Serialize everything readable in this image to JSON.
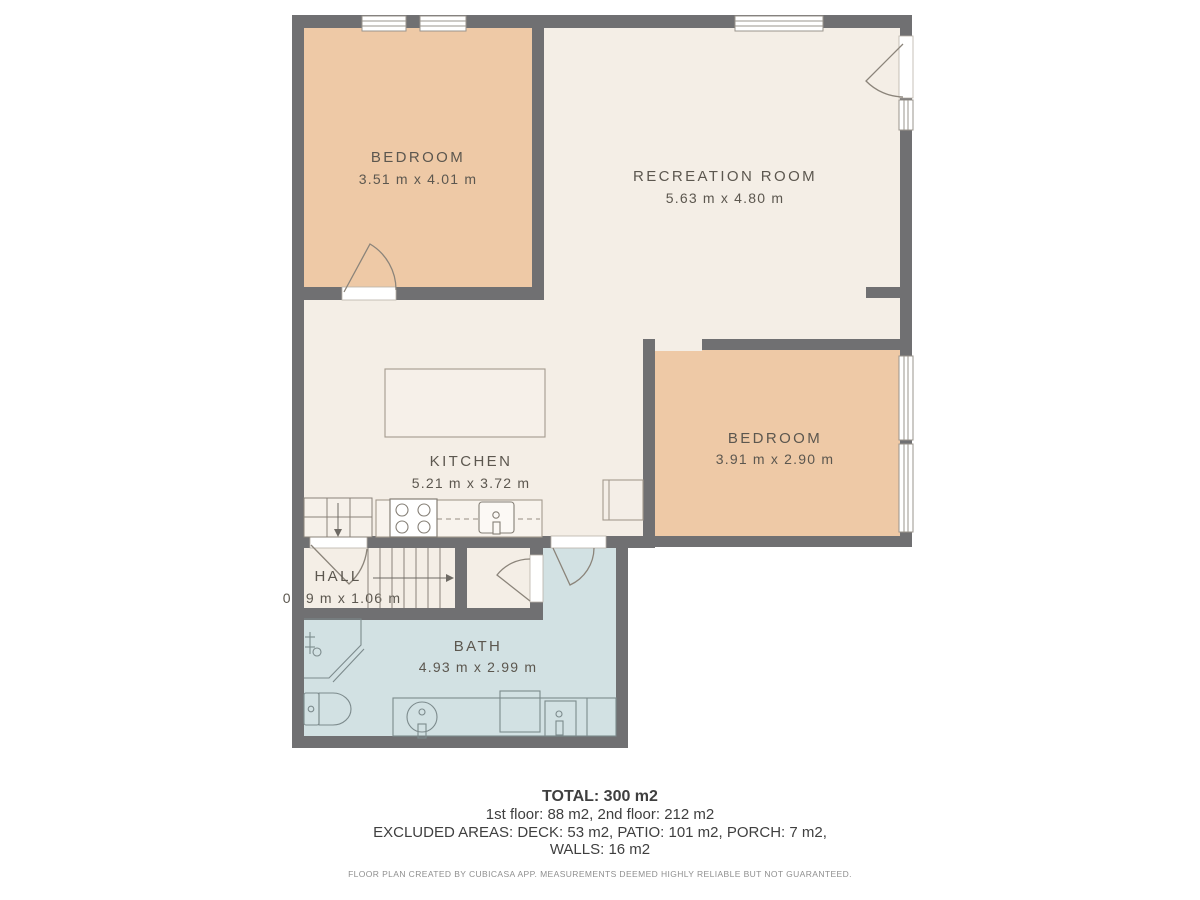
{
  "rooms": [
    {
      "id": "bedroom-1",
      "name": "BEDROOM",
      "dims": "3.51 m x 4.01 m"
    },
    {
      "id": "recreation-room",
      "name": "RECREATION ROOM",
      "dims": "5.63 m x 4.80 m"
    },
    {
      "id": "bedroom-2",
      "name": "BEDROOM",
      "dims": "3.91 m x 2.90 m"
    },
    {
      "id": "kitchen",
      "name": "KITCHEN",
      "dims": "5.21 m x 3.72 m"
    },
    {
      "id": "hall",
      "name": "HALL",
      "dims": "0.99 m x 1.06 m"
    },
    {
      "id": "bath",
      "name": "BATH",
      "dims": "4.93 m x 2.99 m"
    }
  ],
  "summary": {
    "total": "TOTAL: 300 m2",
    "floors": "1st floor: 88 m2, 2nd floor: 212 m2",
    "excluded_line1": "EXCLUDED AREAS: DECK: 53 m2, PATIO: 101 m2, PORCH: 7 m2,",
    "excluded_line2": "WALLS: 16 m2",
    "disclaimer": "FLOOR PLAN CREATED BY CUBICASA APP. MEASUREMENTS DEEMED HIGHLY RELIABLE BUT NOT GUARANTEED."
  },
  "colors": {
    "wall": "#707072",
    "floor_cream": "#f4eee6",
    "bedroom_fill": "#eec9a6",
    "bath_fill": "#d2e1e3",
    "counter_fill": "#f8f3ed",
    "label_text": "#5c574f",
    "fixture_line": "#857f76",
    "bath_fixture_line": "#7c8a8c",
    "footer_text": "#3f3f3f",
    "disclaimer_text": "#8f8f8f"
  }
}
